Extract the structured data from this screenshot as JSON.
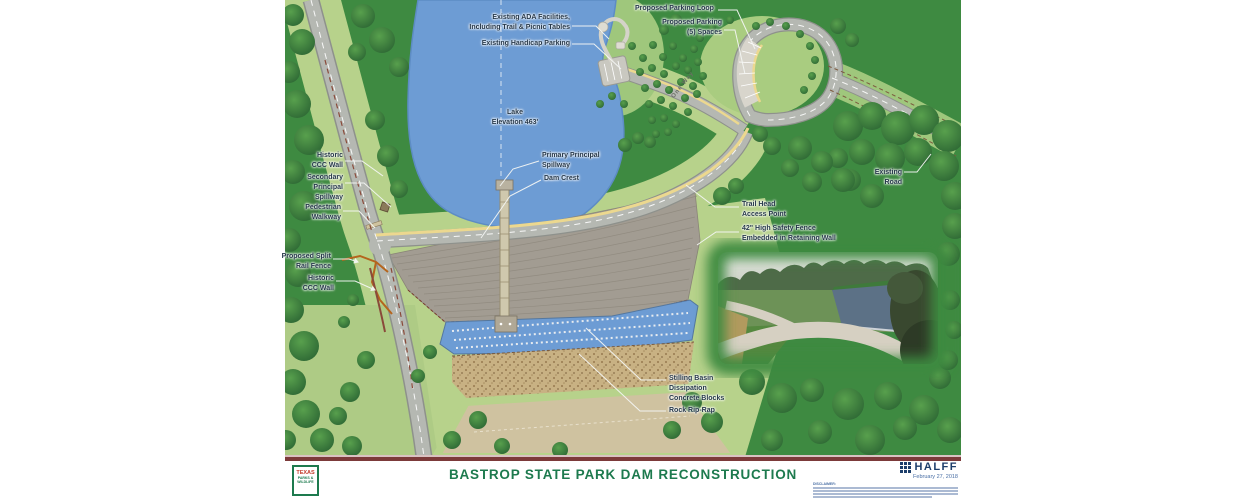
{
  "title_block": {
    "title": "BASTROP STATE PARK DAM RECONSTRUCTION",
    "firm": "HALFF",
    "date": "February 27, 2018",
    "disclaimer_heading": "DISCLAIMER:",
    "agency_logo": {
      "line1": "TEXAS",
      "line2": "PARKS &",
      "line3": "WILDLIFE"
    }
  },
  "map": {
    "road_text": "One Way",
    "labels": {
      "ada": [
        "Existing ADA Facilities,",
        "Including Trail & Picnic Tables"
      ],
      "handicap": [
        "Existing Handicap Parking"
      ],
      "parking_loop": [
        "Proposed Parking Loop"
      ],
      "parking_spaces": [
        "Proposed Parking",
        "(5) Spaces"
      ],
      "lake": [
        "Lake",
        "Elevation 463'"
      ],
      "historic_ccc_upper": [
        "Historic",
        "CCC Wall"
      ],
      "secondary_spillway": [
        "Secondary",
        "Principal",
        "Spillway"
      ],
      "pedestrian_walkway": [
        "Pedestrian",
        "Walkway"
      ],
      "primary_spillway": [
        "Primary Principal",
        "Spillway"
      ],
      "dam_crest": [
        "Dam Crest"
      ],
      "trail_head": [
        "Trail Head",
        "Access Point"
      ],
      "safety_fence": [
        "42\" High Safety Fence",
        "Embedded in Retaining Wall"
      ],
      "existing_road": [
        "Existing",
        "Road"
      ],
      "split_rail_fence": [
        "Proposed Split",
        "Rail Fence"
      ],
      "historic_ccc_lower": [
        "Historic",
        "CCC Wall"
      ],
      "stilling_basin": [
        "Stilling Basin",
        "Dissipation",
        "Concrete Blocks"
      ],
      "rock_riprap": [
        "Rock Rip-Rap"
      ]
    },
    "colors": {
      "field_green": "#3e8a41",
      "meadow_green": "#b7d28b",
      "lake_blue": "#6d9cd4",
      "road_grey": "#b5b8b2",
      "crest_yellow": "#ecd88f",
      "dam_grey": "#a29c92",
      "maroon": "#7c3a3a",
      "title_green": "#1d7a4e",
      "halff_navy": "#1d3e6b"
    }
  }
}
